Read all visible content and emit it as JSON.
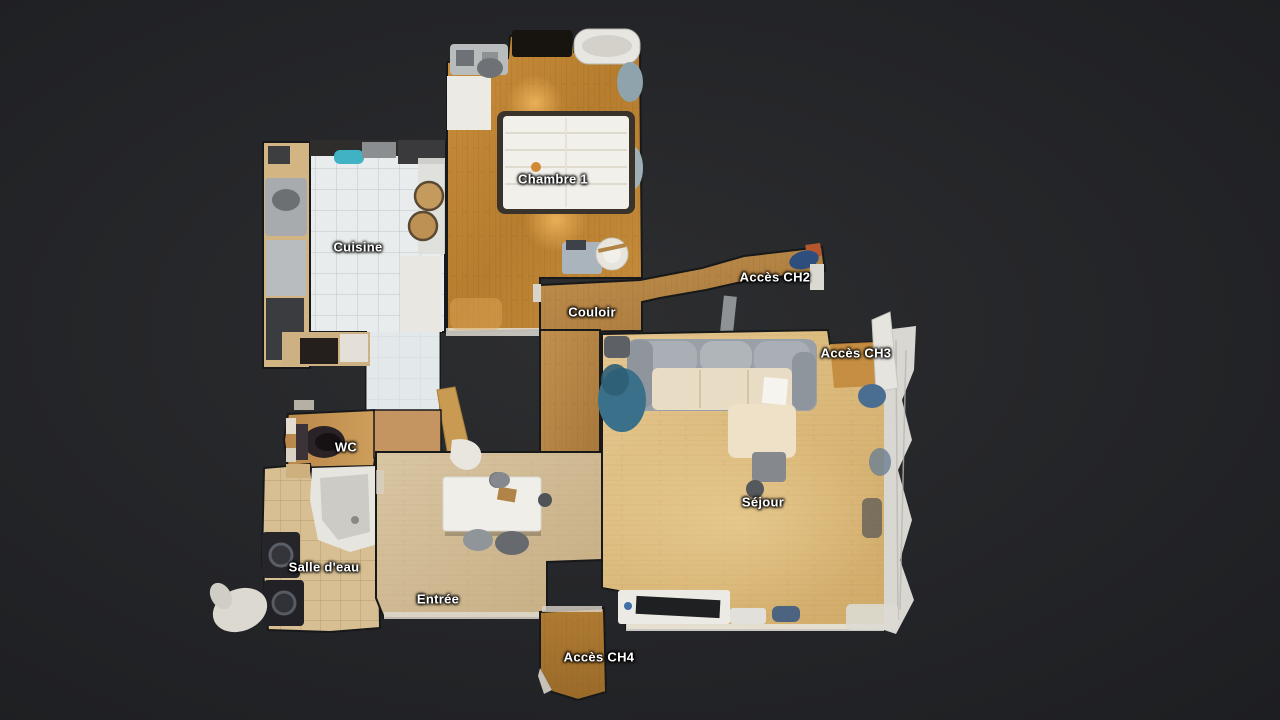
{
  "view": {
    "type": "floorplan-top-view",
    "background_color": "#242528"
  },
  "floorplan": {
    "labels": [
      {
        "id": "chambre1",
        "text": "Chambre 1",
        "x": 553,
        "y": 179
      },
      {
        "id": "cuisine",
        "text": "Cuisine",
        "x": 358,
        "y": 247
      },
      {
        "id": "acces-ch2",
        "text": "Accès CH2",
        "x": 775,
        "y": 277
      },
      {
        "id": "couloir",
        "text": "Couloir",
        "x": 592,
        "y": 312
      },
      {
        "id": "acces-ch3",
        "text": "Accès CH3",
        "x": 856,
        "y": 353
      },
      {
        "id": "wc",
        "text": "WC",
        "x": 346,
        "y": 447
      },
      {
        "id": "sejour",
        "text": "Séjour",
        "x": 763,
        "y": 502
      },
      {
        "id": "salle-deau",
        "text": "Salle d'eau",
        "x": 324,
        "y": 567
      },
      {
        "id": "entree",
        "text": "Entrée",
        "x": 438,
        "y": 599
      },
      {
        "id": "acces-ch4",
        "text": "Accès CH4",
        "x": 599,
        "y": 657
      }
    ],
    "colors": {
      "label_text": "#ffffff",
      "wood_chambre": "#b9802f",
      "wood_couloir": "#b3823f",
      "wood_sejour": "#ddbd85",
      "wood_entree": "#cfb890",
      "wood_wc": "#c89a55",
      "tile_kitchen": "#e9ecec",
      "tile_bathroom": "#d7bf93",
      "sofa_gray": "#9aa0a7",
      "sofa_cream": "#e9dcc4",
      "beanbag_teal": "#3a7089",
      "appliance_dark": "#26262a",
      "furniture_white": "#efeee9"
    }
  }
}
